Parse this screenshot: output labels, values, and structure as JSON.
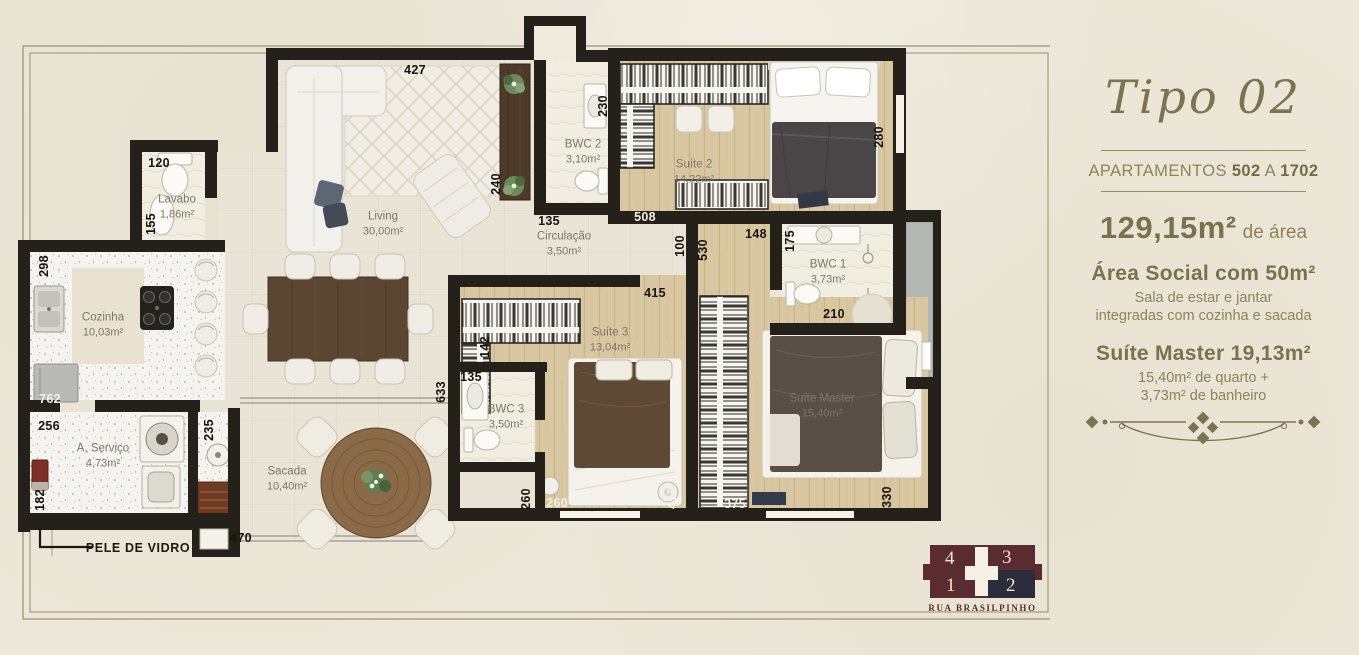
{
  "panel": {
    "title": "Tipo 02",
    "apartments_prefix": "APARTAMENTOS",
    "apartments_from": "502",
    "apartments_connector": "A",
    "apartments_to": "1702",
    "total_area_value": "129,15m²",
    "total_area_suffix": "de área",
    "social_heading": "Área Social com 50m²",
    "social_line1": "Sala de estar e jantar",
    "social_line2": "integradas com cozinha e sacada",
    "suite_heading": "Suíte Master 19,13m²",
    "suite_line1": "15,40m² de quarto +",
    "suite_line2": "3,73m² de banheiro"
  },
  "keyplan": {
    "units": [
      {
        "label": "4",
        "highlighted": false
      },
      {
        "label": "3",
        "highlighted": false
      },
      {
        "label": "1",
        "highlighted": false
      },
      {
        "label": "2",
        "highlighted": true
      }
    ],
    "street": "RUA BRASILPINHO",
    "colors": {
      "base": "#5b2b32",
      "highlight": "#2b2d3d"
    }
  },
  "plan": {
    "glass_label": "PELE DE VIDRO",
    "rooms": [
      {
        "name": "Lavabo",
        "area": "1,86m²",
        "x": 177,
        "y": 207
      },
      {
        "name": "Living",
        "area": "30,00m²",
        "x": 383,
        "y": 224
      },
      {
        "name": "Cozinha",
        "area": "10,03m²",
        "x": 103,
        "y": 325
      },
      {
        "name": "Circulação",
        "area": "3,50m²",
        "x": 564,
        "y": 244
      },
      {
        "name": "BWC 2",
        "area": "3,10m²",
        "x": 583,
        "y": 152
      },
      {
        "name": "Suíte 2",
        "area": "14,22m²",
        "x": 694,
        "y": 172
      },
      {
        "name": "BWC 1",
        "area": "3,73m²",
        "x": 828,
        "y": 272
      },
      {
        "name": "Suíte 3",
        "area": "13,04m²",
        "x": 610,
        "y": 340
      },
      {
        "name": "BWC 3",
        "area": "3,50m²",
        "x": 506,
        "y": 417
      },
      {
        "name": "A. Serviço",
        "area": "4,73m²",
        "x": 103,
        "y": 456
      },
      {
        "name": "Sacada",
        "area": "10,40m²",
        "x": 287,
        "y": 479
      },
      {
        "name": "Suíte Master",
        "area": "15,40m²",
        "x": 822,
        "y": 406
      }
    ],
    "dimensions": [
      {
        "v": "427",
        "x": 415,
        "y": 70
      },
      {
        "v": "230",
        "x": 603,
        "y": 106,
        "rot": true
      },
      {
        "v": "280",
        "x": 879,
        "y": 137,
        "rot": true
      },
      {
        "v": "120",
        "x": 159,
        "y": 163
      },
      {
        "v": "155",
        "x": 151,
        "y": 224,
        "rot": true
      },
      {
        "v": "240",
        "x": 496,
        "y": 184,
        "rot": true
      },
      {
        "v": "135",
        "x": 549,
        "y": 221
      },
      {
        "v": "508",
        "x": 645,
        "y": 217,
        "white": true
      },
      {
        "v": "148",
        "x": 756,
        "y": 234
      },
      {
        "v": "175",
        "x": 790,
        "y": 241,
        "rot": true
      },
      {
        "v": "100",
        "x": 680,
        "y": 246,
        "rot": true
      },
      {
        "v": "530",
        "x": 703,
        "y": 250,
        "rot": true
      },
      {
        "v": "298",
        "x": 44,
        "y": 266,
        "rot": true
      },
      {
        "v": "415",
        "x": 655,
        "y": 293
      },
      {
        "v": "210",
        "x": 834,
        "y": 314
      },
      {
        "v": "142",
        "x": 485,
        "y": 347,
        "rot": true
      },
      {
        "v": "135",
        "x": 471,
        "y": 377
      },
      {
        "v": "633",
        "x": 441,
        "y": 392,
        "rot": true
      },
      {
        "v": "762",
        "x": 50,
        "y": 399,
        "white": true
      },
      {
        "v": "256",
        "x": 49,
        "y": 426
      },
      {
        "v": "182",
        "x": 40,
        "y": 500,
        "rot": true
      },
      {
        "v": "235",
        "x": 209,
        "y": 430,
        "rot": true
      },
      {
        "v": "470",
        "x": 241,
        "y": 538
      },
      {
        "v": "260",
        "x": 526,
        "y": 499,
        "rot": true
      },
      {
        "v": "260",
        "x": 557,
        "y": 503,
        "white": true
      },
      {
        "v": "418",
        "x": 672,
        "y": 498,
        "rot": true,
        "white": true
      },
      {
        "v": "375",
        "x": 735,
        "y": 504,
        "white": true
      },
      {
        "v": "330",
        "x": 887,
        "y": 497,
        "rot": true
      }
    ]
  },
  "colors": {
    "paper": "#ece7d8",
    "olive_text": "#7c7350",
    "wall": "#24201a",
    "wood_floor": "#d9c7a1",
    "keyplan_base": "#5b2b32",
    "keyplan_highlight": "#2b2d3d"
  }
}
